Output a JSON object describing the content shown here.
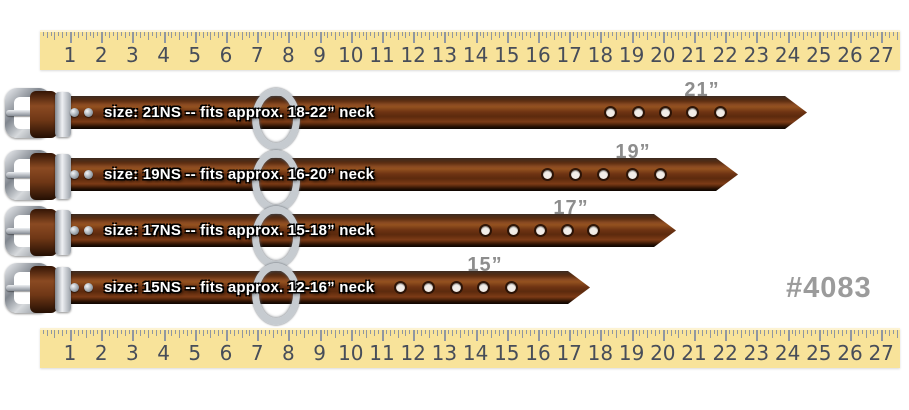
{
  "page": {
    "background": "#ffffff",
    "product_code": "#4083",
    "product_code_color": "#9b9b9b"
  },
  "ruler": {
    "unit": "inches",
    "numbers": [
      "1",
      "2",
      "3",
      "4",
      "5",
      "6",
      "7",
      "8",
      "9",
      "10",
      "11",
      "12",
      "13",
      "14",
      "15",
      "16",
      "17",
      "18",
      "19",
      "20",
      "21",
      "22",
      "23",
      "24",
      "25",
      "26",
      "27"
    ],
    "bg_color": "#f8e39a",
    "tick_color": "#9097a1",
    "number_color": "#474d59"
  },
  "straps": [
    {
      "id": "21NS",
      "size_text": "21”",
      "label": "size: 21NS -- fits approx. 18-22” neck",
      "holes": 5
    },
    {
      "id": "19NS",
      "size_text": "19”",
      "label": "size: 19NS -- fits approx. 16-20” neck",
      "holes": 5
    },
    {
      "id": "17NS",
      "size_text": "17”",
      "label": "size: 17NS -- fits approx. 15-18” neck",
      "holes": 5
    },
    {
      "id": "15NS",
      "size_text": "15”",
      "label": "size: 15NS -- fits approx. 12-16” neck",
      "holes": 5
    }
  ],
  "colors": {
    "leather_mid": "#6f3413",
    "leather_light": "#8a4a22",
    "metal_light": "#eef0f3",
    "metal_mid": "#d7dadd",
    "metal_dark": "#80868e",
    "size_label_color": "#8d8d8d"
  }
}
